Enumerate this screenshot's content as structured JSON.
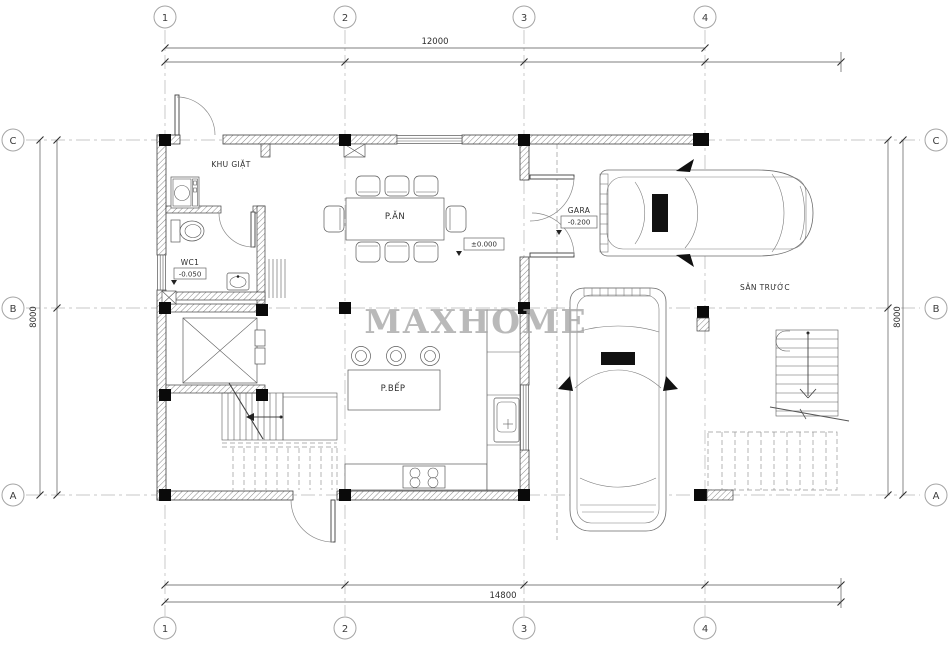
{
  "watermark": "MAXHOME",
  "grid": {
    "cols": [
      "1",
      "2",
      "3",
      "4"
    ],
    "rows": [
      "C",
      "B",
      "A"
    ]
  },
  "dims": {
    "top": "12000",
    "bottom": "14800",
    "left": "8000",
    "right": "8000"
  },
  "labels": {
    "laundry": "KHU GIẶT",
    "wc": "WC1",
    "wc_level": "-0.050",
    "dining": "P.ĂN",
    "dining_level": "±0.000",
    "garage": "GARA",
    "garage_level": "-0.200",
    "kitchen": "P.BẾP",
    "front_yard": "SÂN TRƯỚC"
  },
  "colors": {
    "line": "#3f3f3f",
    "grid": "#b5b5b5",
    "column": "#0a0a0a",
    "watermark": "#a8a8a8"
  }
}
